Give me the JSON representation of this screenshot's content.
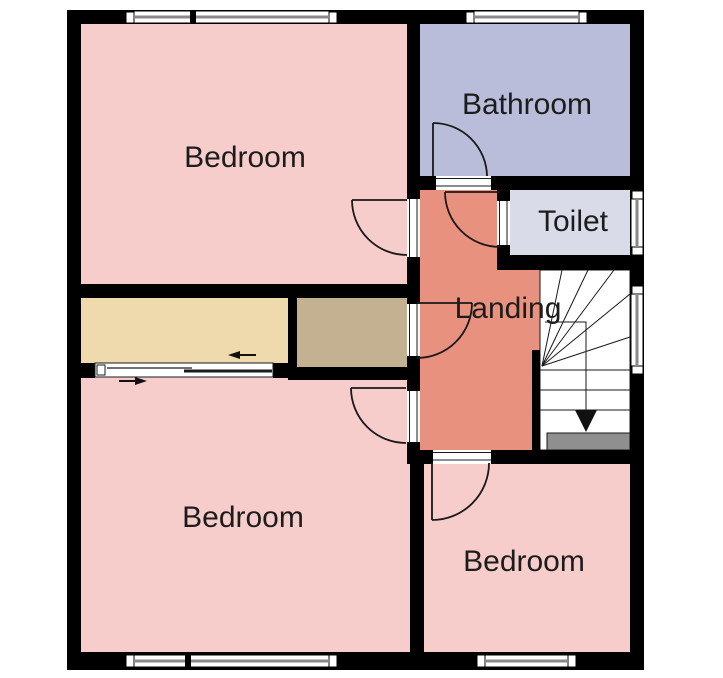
{
  "plan": {
    "type_label": "floor-plan",
    "background": "#ffffff",
    "wall_color": "#000000",
    "label_color": "#1c1c1c",
    "line_color": "#1a1a1a",
    "glazing_line_color": "#8a8a8a"
  },
  "rooms": {
    "bedroom_top_left": {
      "label": "Bedroom",
      "color": "#f7cdcc"
    },
    "bathroom": {
      "label": "Bathroom",
      "color": "#b9bdd9"
    },
    "toilet": {
      "label": "Toilet",
      "color": "#d9dbe9"
    },
    "landing": {
      "label": "Landing",
      "color": "#e9917f"
    },
    "store_left": {
      "label": "",
      "color": "#eedaad"
    },
    "store_right": {
      "label": "",
      "color": "#c3b192"
    },
    "bedroom_bottom_left": {
      "label": "Bedroom",
      "color": "#f7cdcc"
    },
    "bedroom_bottom_right": {
      "label": "Bedroom",
      "color": "#f7cdcc"
    }
  },
  "stairs": {
    "tread_color": "#ffffff",
    "half_landing_color": "#8f8f8f",
    "direction": "down-arrow"
  }
}
